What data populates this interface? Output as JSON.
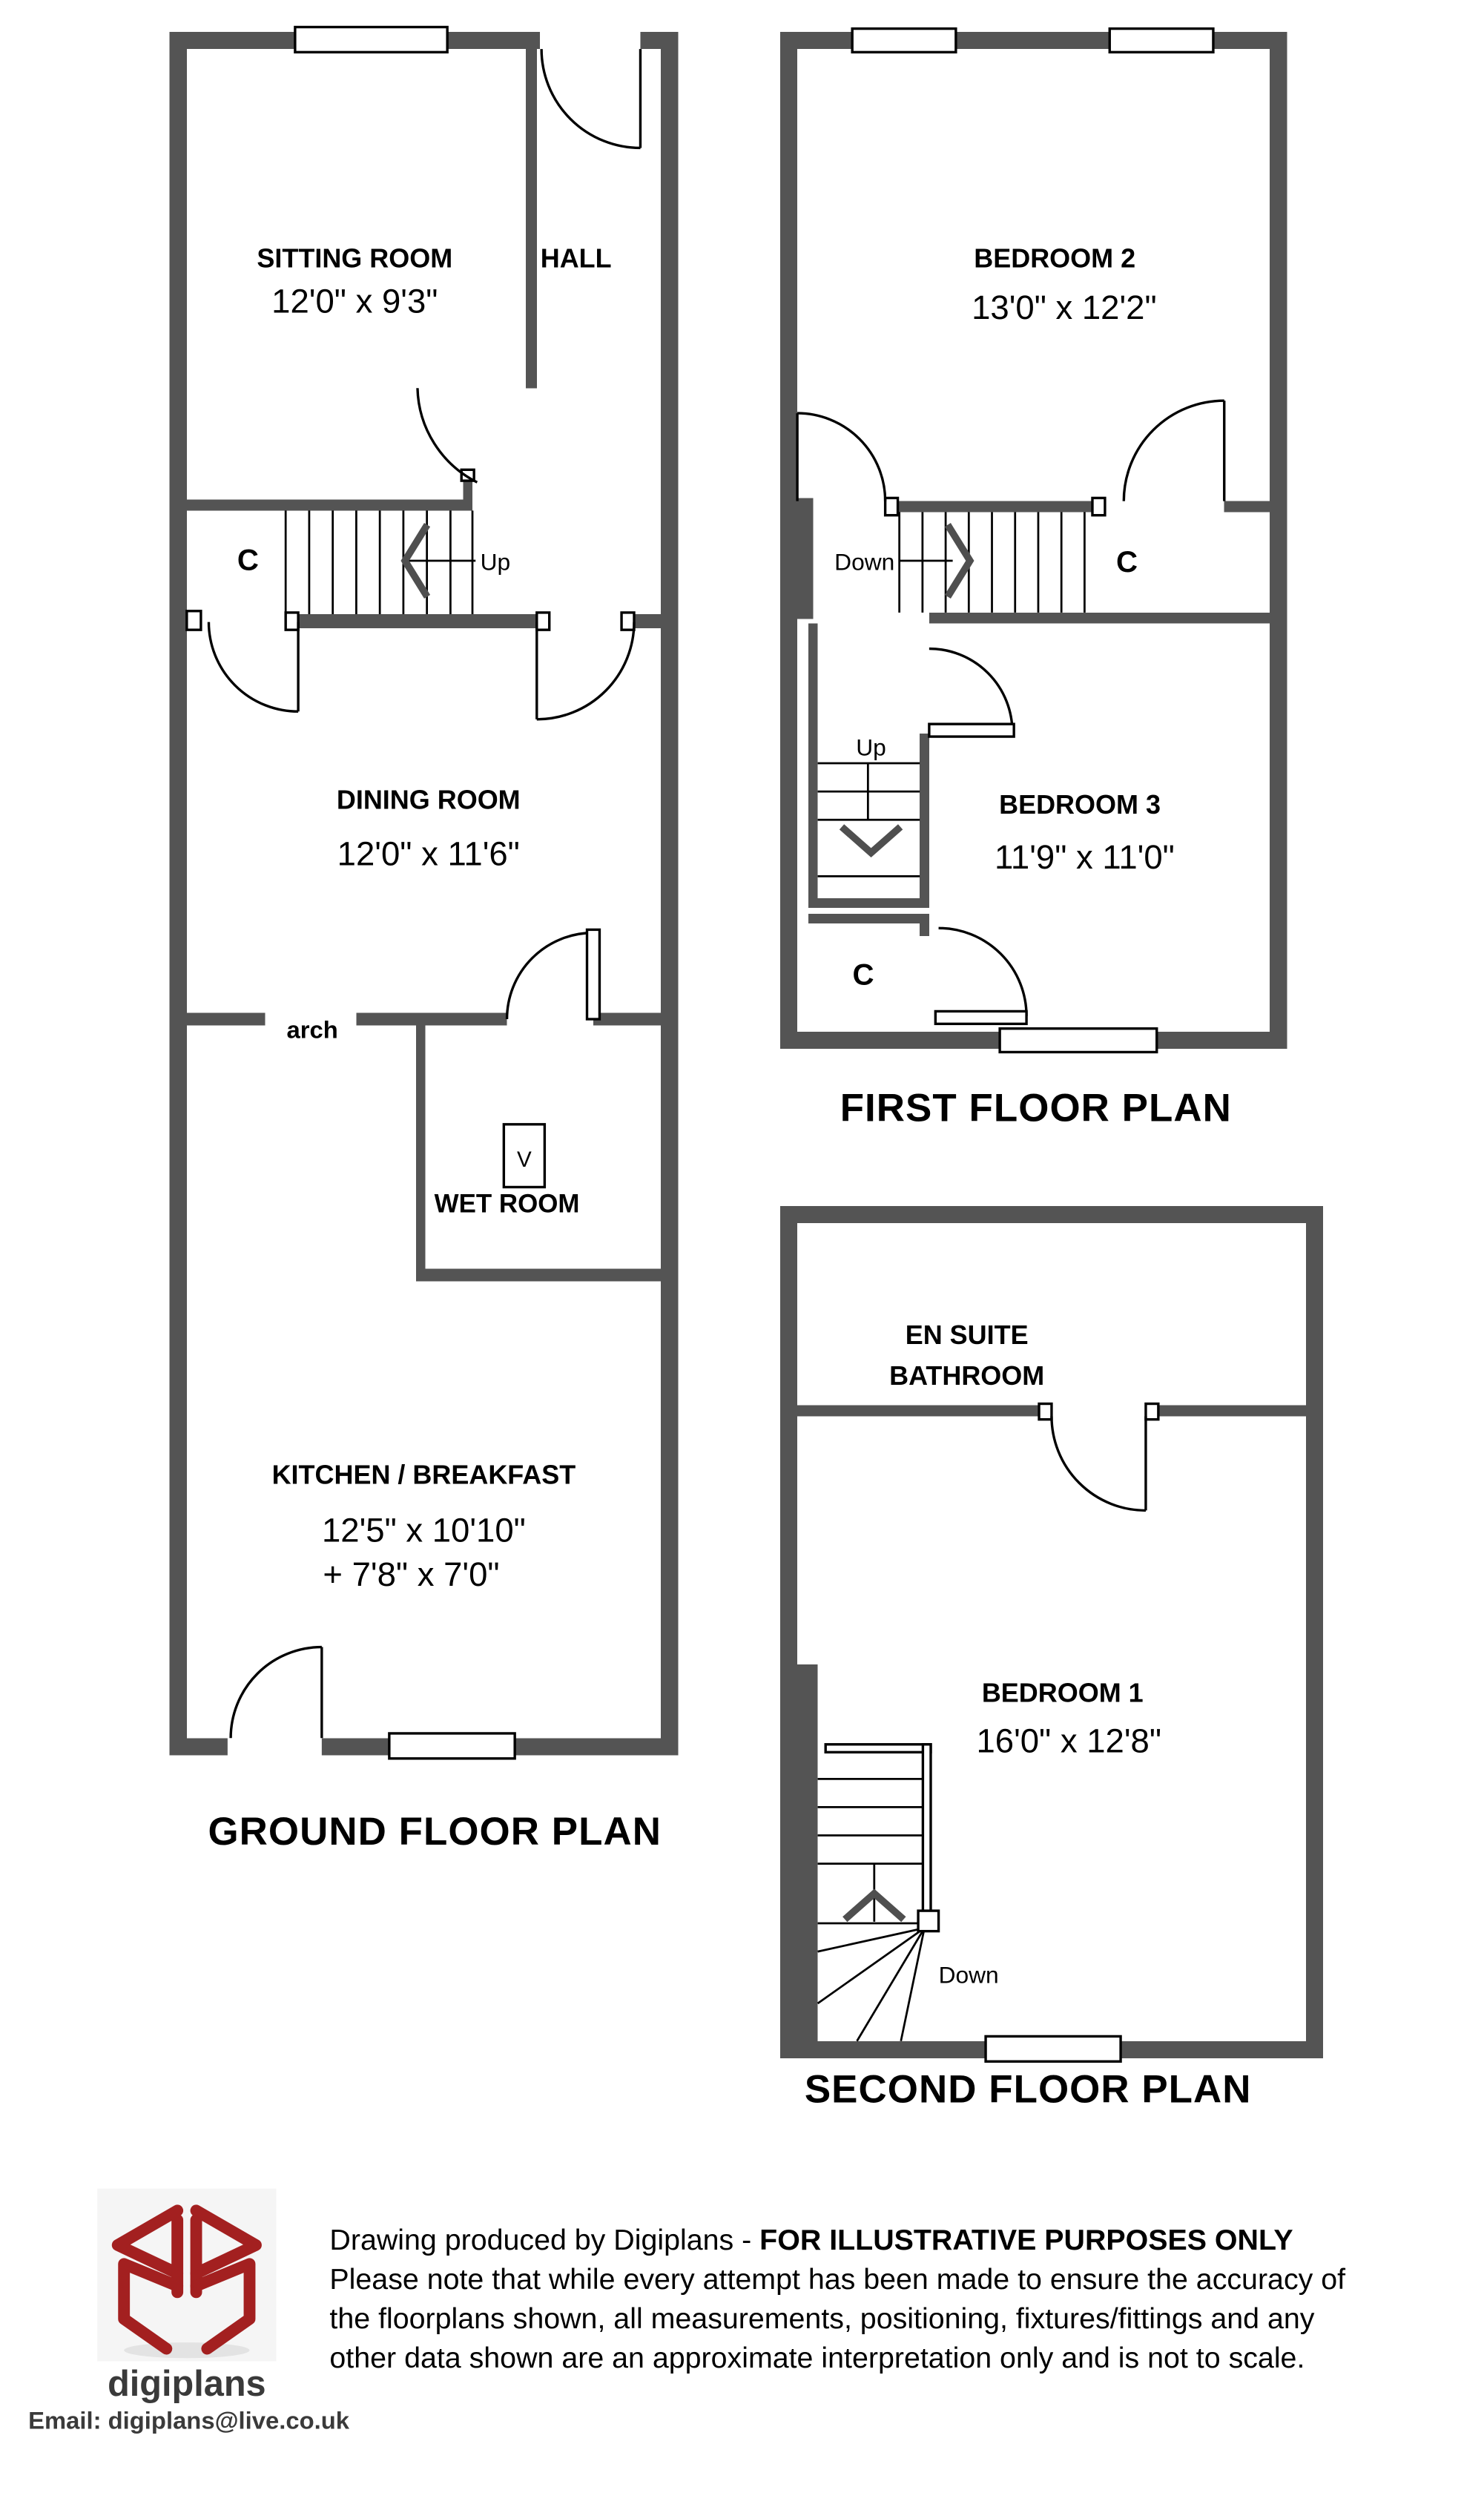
{
  "ground_floor": {
    "title": "GROUND FLOOR PLAN",
    "rooms": {
      "sitting_room": {
        "name": "SITTING ROOM",
        "dims": "12'0\" x 9'3\""
      },
      "hall": {
        "name": "HALL"
      },
      "dining_room": {
        "name": "DINING ROOM",
        "dims": "12'0\" x 11'6\""
      },
      "wet_room": {
        "name": "WET ROOM"
      },
      "kitchen": {
        "name": "KITCHEN / BREAKFAST",
        "dims": "12'5\" x 10'10\"",
        "dims2": "+ 7'8\" x 7'0\""
      }
    },
    "labels": {
      "cupboard": "C",
      "up": "Up",
      "arch": "arch",
      "vent": "V"
    }
  },
  "first_floor": {
    "title": "FIRST FLOOR PLAN",
    "rooms": {
      "bedroom2": {
        "name": "BEDROOM 2",
        "dims": "13'0\" x 12'2\""
      },
      "bedroom3": {
        "name": "BEDROOM 3",
        "dims": "11'9\" x 11'0\""
      }
    },
    "labels": {
      "down": "Down",
      "up": "Up",
      "cupboard_right": "C",
      "cupboard_closet": "C"
    }
  },
  "second_floor": {
    "title": "SECOND FLOOR PLAN",
    "rooms": {
      "ensuite": {
        "name_line1": "EN SUITE",
        "name_line2": "BATHROOM"
      },
      "bedroom1": {
        "name": "BEDROOM 1",
        "dims": "16'0\" x 12'8\""
      }
    },
    "labels": {
      "down": "Down"
    }
  },
  "footer": {
    "logo_text": "digiplans",
    "email": "Email: digiplans@live.co.uk",
    "line1_normal": "Drawing produced by Digiplans - ",
    "line1_bold": "FOR ILLUSTRATIVE PURPOSES ONLY",
    "line2": "Please note that while every attempt has been made to ensure the accuracy of",
    "line3": "the floorplans shown, all measurements, positioning, fixtures/fittings and any",
    "line4": "other data shown are an approximate interpretation only and is not to scale."
  },
  "colors": {
    "wall": "#545454",
    "line": "#000000",
    "logo_red": "#a32020"
  }
}
